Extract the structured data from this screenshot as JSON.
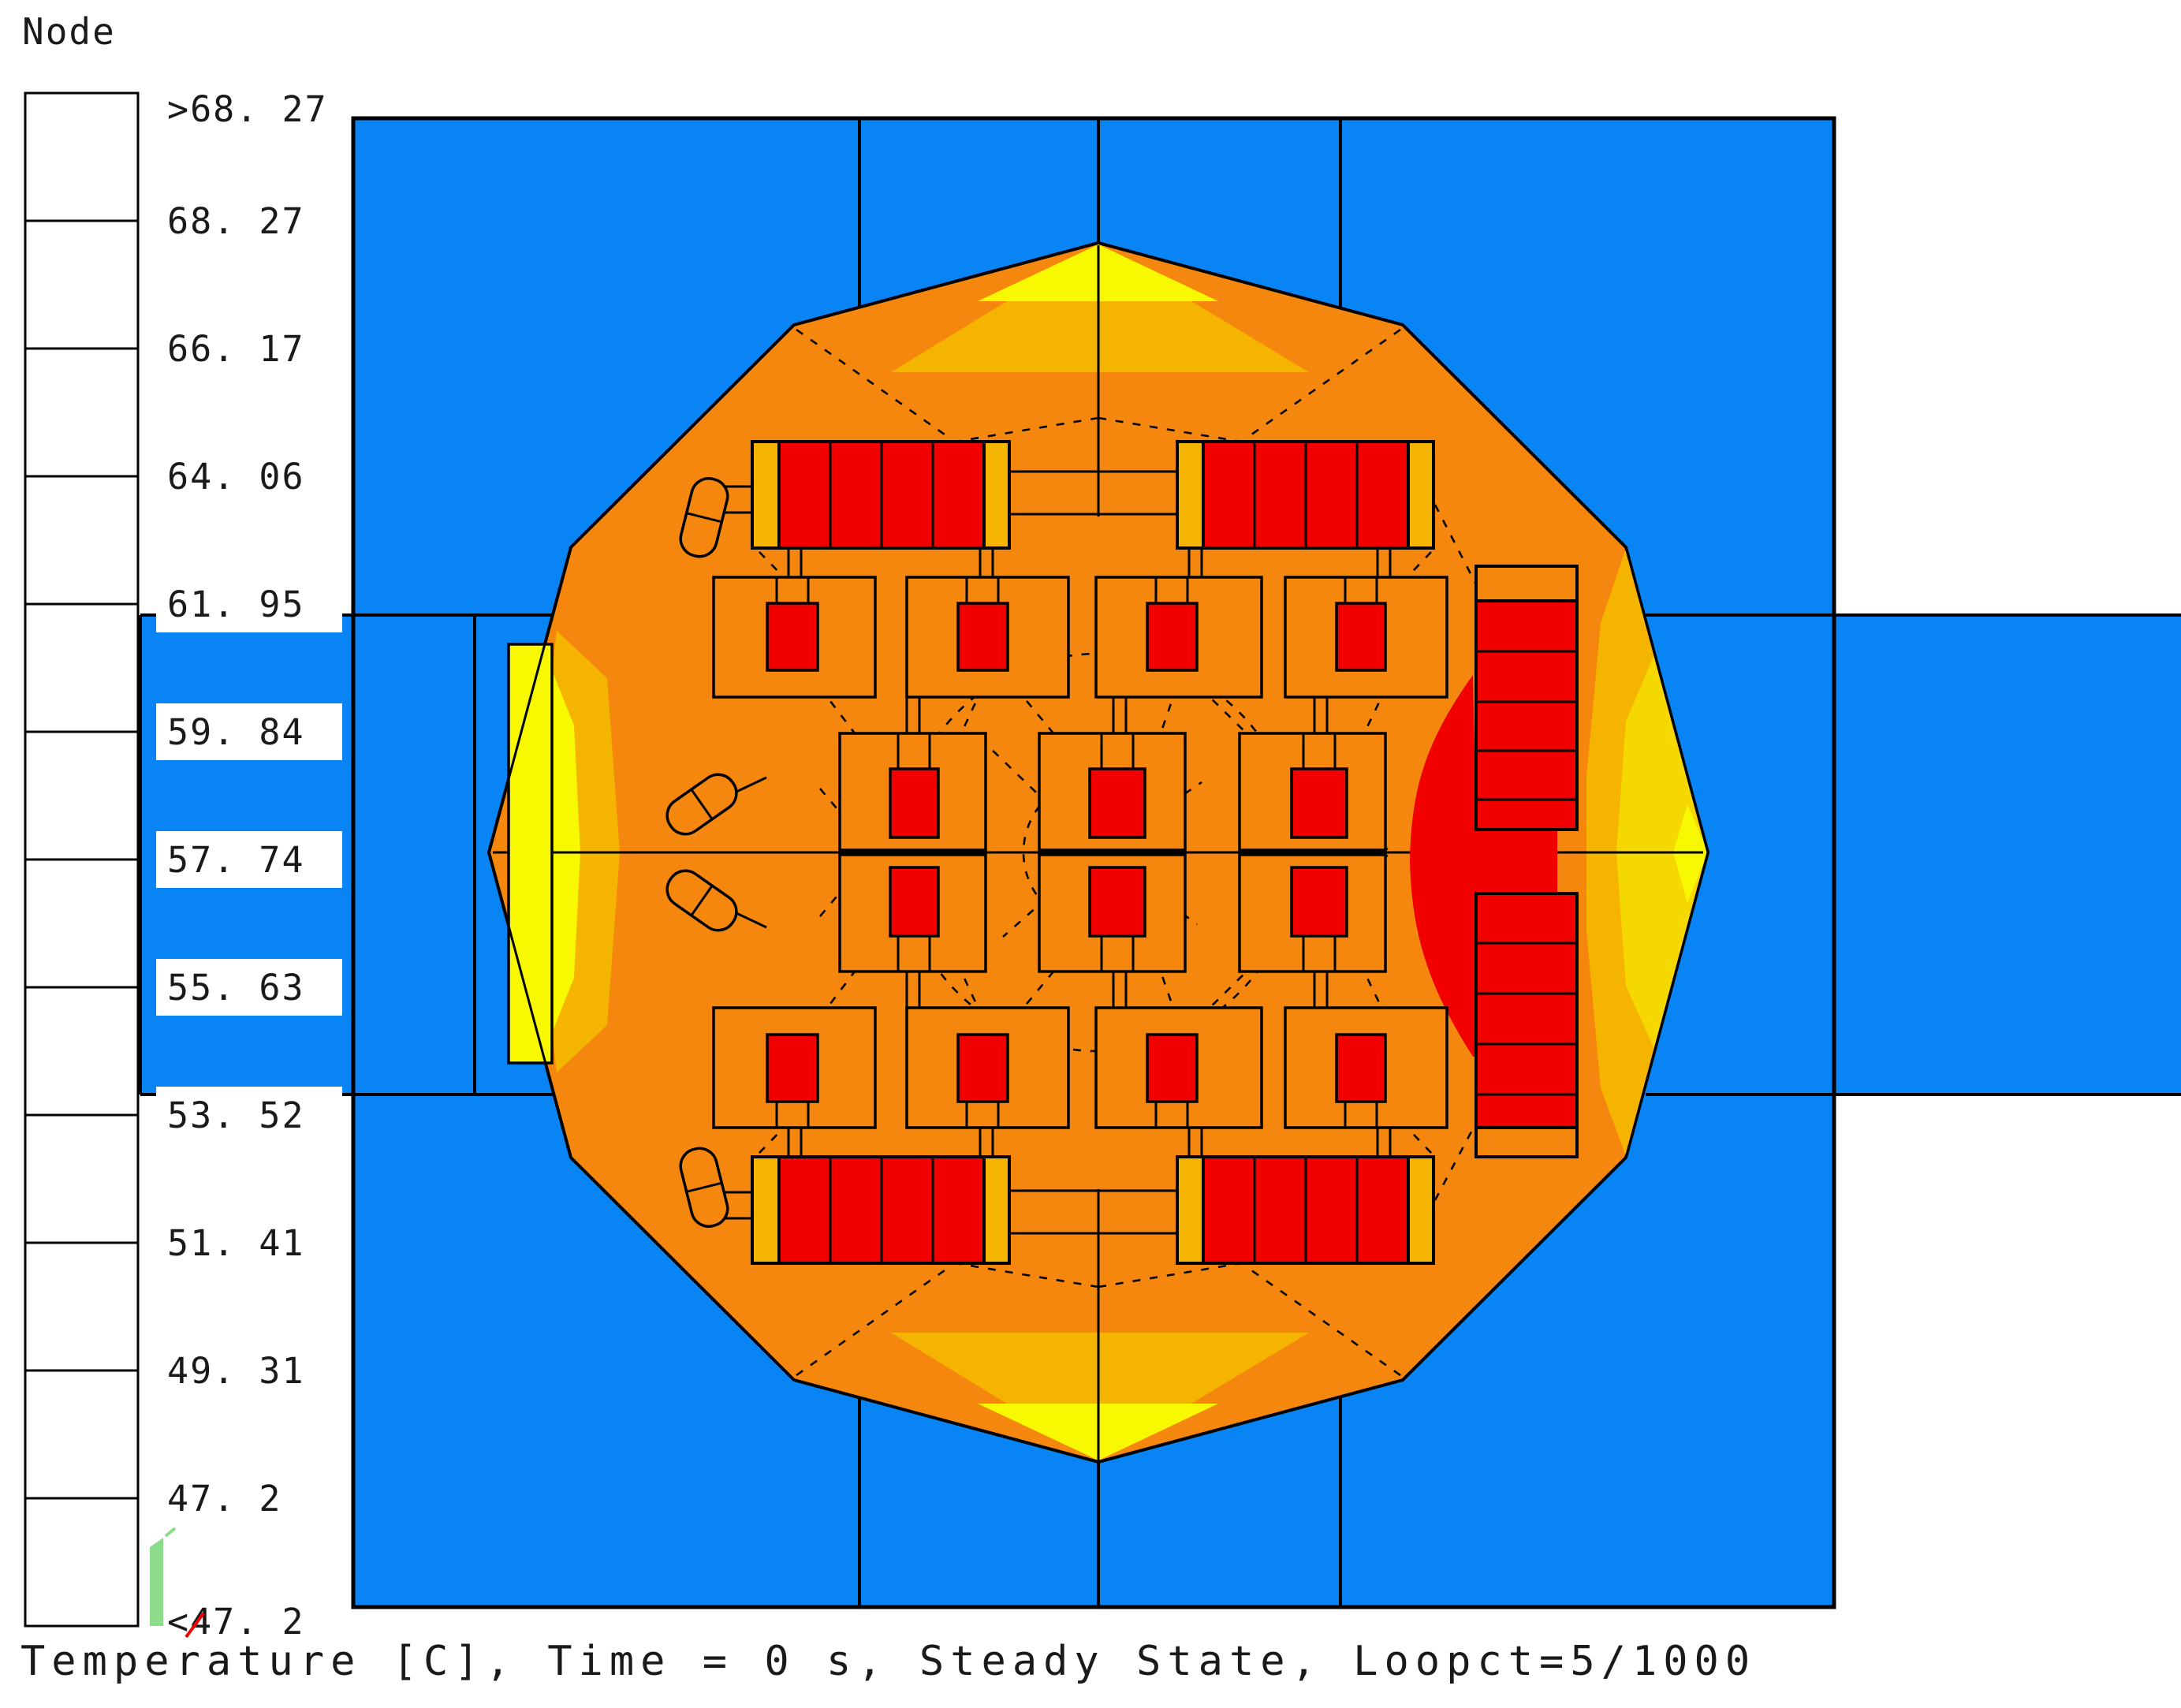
{
  "legend": {
    "title": "Node",
    "labels": [
      ">68. 27",
      "68. 27",
      "66. 17",
      "64. 06",
      "61. 95",
      "59. 84",
      "57. 74",
      "55. 63",
      "53. 52",
      "51. 41",
      "49. 31",
      "47. 2",
      "<47. 2"
    ]
  },
  "caption": "Temperature [C], Time = 0 s, Steady State, Loopct=5/1000",
  "colors": {
    "magenta": "#F57AF5",
    "red": "#F20000",
    "orange": "#F5870F",
    "amber": "#F5B400",
    "yellow": "#F8F800",
    "yellow_soft": "#F5D800",
    "yellow_green": "#A8D800",
    "green": "#00C310",
    "spring_green": "#00DC8C",
    "cyan": "#00E6E6",
    "sky_blue": "#3DA5F5",
    "blue": "#0884F5",
    "navy": "#2E0A64",
    "light_green": "#8CDC8C",
    "line": "#000000",
    "text": "#1A1A1A",
    "white": "#FFFFFF"
  },
  "chart_data": {
    "type": "heatmap",
    "title": "Node",
    "units": "Temperature [C]",
    "time": "0 s",
    "state": "Steady State",
    "loopct": "5/1000",
    "caption": "Temperature [C], Time = 0 s, Steady State, Loopct=5/1000",
    "scale_breaks": [
      68.27,
      66.17,
      64.06,
      61.95,
      59.84,
      57.74,
      55.63,
      53.52,
      51.41,
      49.31,
      47.2
    ],
    "scale_note": "13 labels: top band is >68.27, bottom band is <47.2; 12 color bands between",
    "scale_colors_top_to_bottom": [
      "#F57AF5",
      "#F20000",
      "#F5870F",
      "#F5B400",
      "#F8F800",
      "#A8D800",
      "#00C310",
      "#00DC8C",
      "#00E6E6",
      "#3DA5F5",
      "#0884F5",
      "#2E0A64"
    ],
    "legend_position": "left",
    "regions": [
      {
        "name": "surrounding-medium-square",
        "temp_band": "47.2-49.31",
        "color": "#0884F5"
      },
      {
        "name": "left-and-right-coolant-ducts",
        "temp_band": "47.2-49.31",
        "color": "#0884F5"
      },
      {
        "name": "cask-body-dodecagon",
        "temp_band": "64.06-66.17",
        "color": "#F5870F"
      },
      {
        "name": "rim-contour-bands-at-cardinal-vertices",
        "temp_band": "59.84-64.06",
        "color": "#F5B400 / #F8F800"
      },
      {
        "name": "fuel-assembly-blocks-grid",
        "temp_band": "66.17-68.27",
        "color": "#F20000"
      },
      {
        "name": "right-side-hot-zone-and-stacks",
        "temp_band": "66.17-68.27",
        "color": "#F20000"
      },
      {
        "name": "left-window-plate",
        "temp_band": "59.84-61.95",
        "color": "#F8F800"
      }
    ]
  }
}
